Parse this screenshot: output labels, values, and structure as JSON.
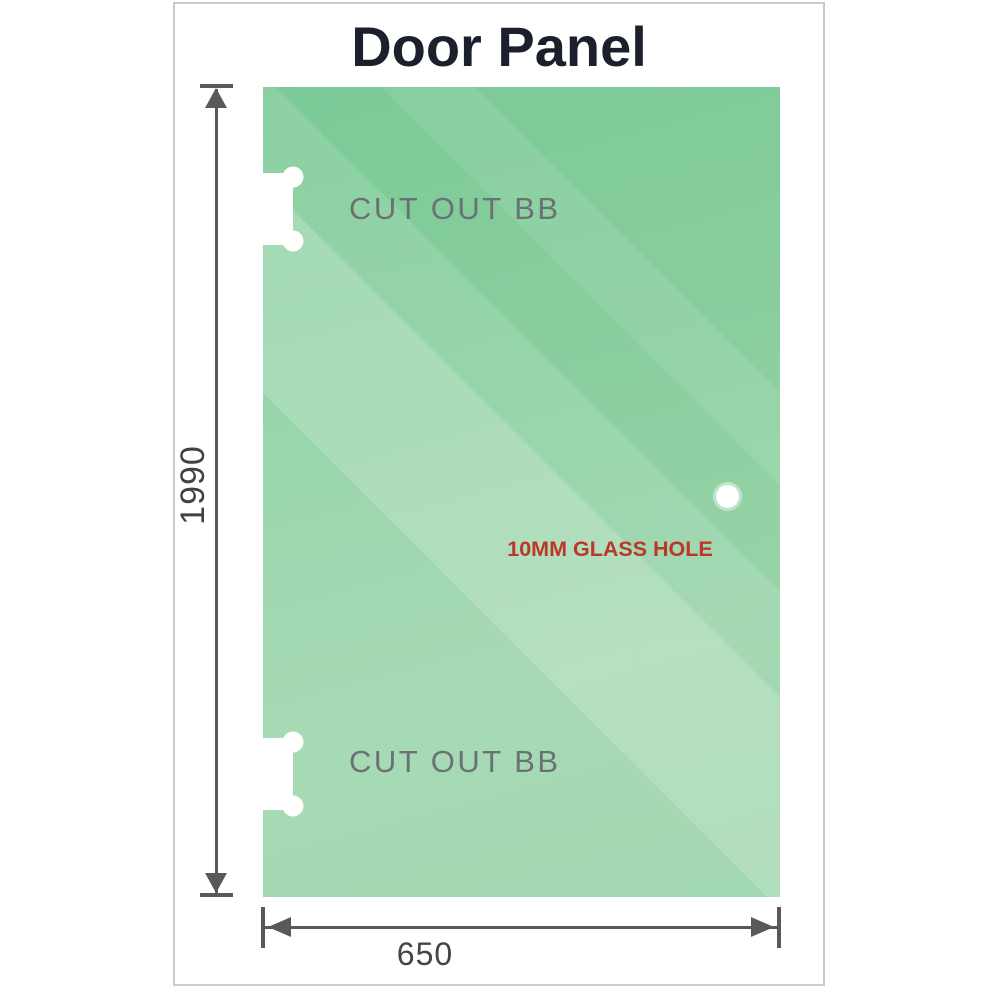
{
  "title": "Door Panel",
  "panel": {
    "cutouts": [
      {
        "label": "CUT OUT BB"
      },
      {
        "label": "CUT OUT BB"
      }
    ],
    "hole": {
      "label": "10MM GLASS HOLE"
    }
  },
  "dimensions": {
    "height": {
      "value": "1990"
    },
    "width": {
      "value": "650"
    }
  },
  "colors": {
    "panel_green_dark": "#7bca96",
    "panel_green_light": "#a9dcb8",
    "dimension_gray": "#58595b",
    "hole_label_red": "#bd3728",
    "cutout_label_gray": "#6b7174",
    "title_color": "#1b202c",
    "frame_border": "#c9cccc"
  }
}
